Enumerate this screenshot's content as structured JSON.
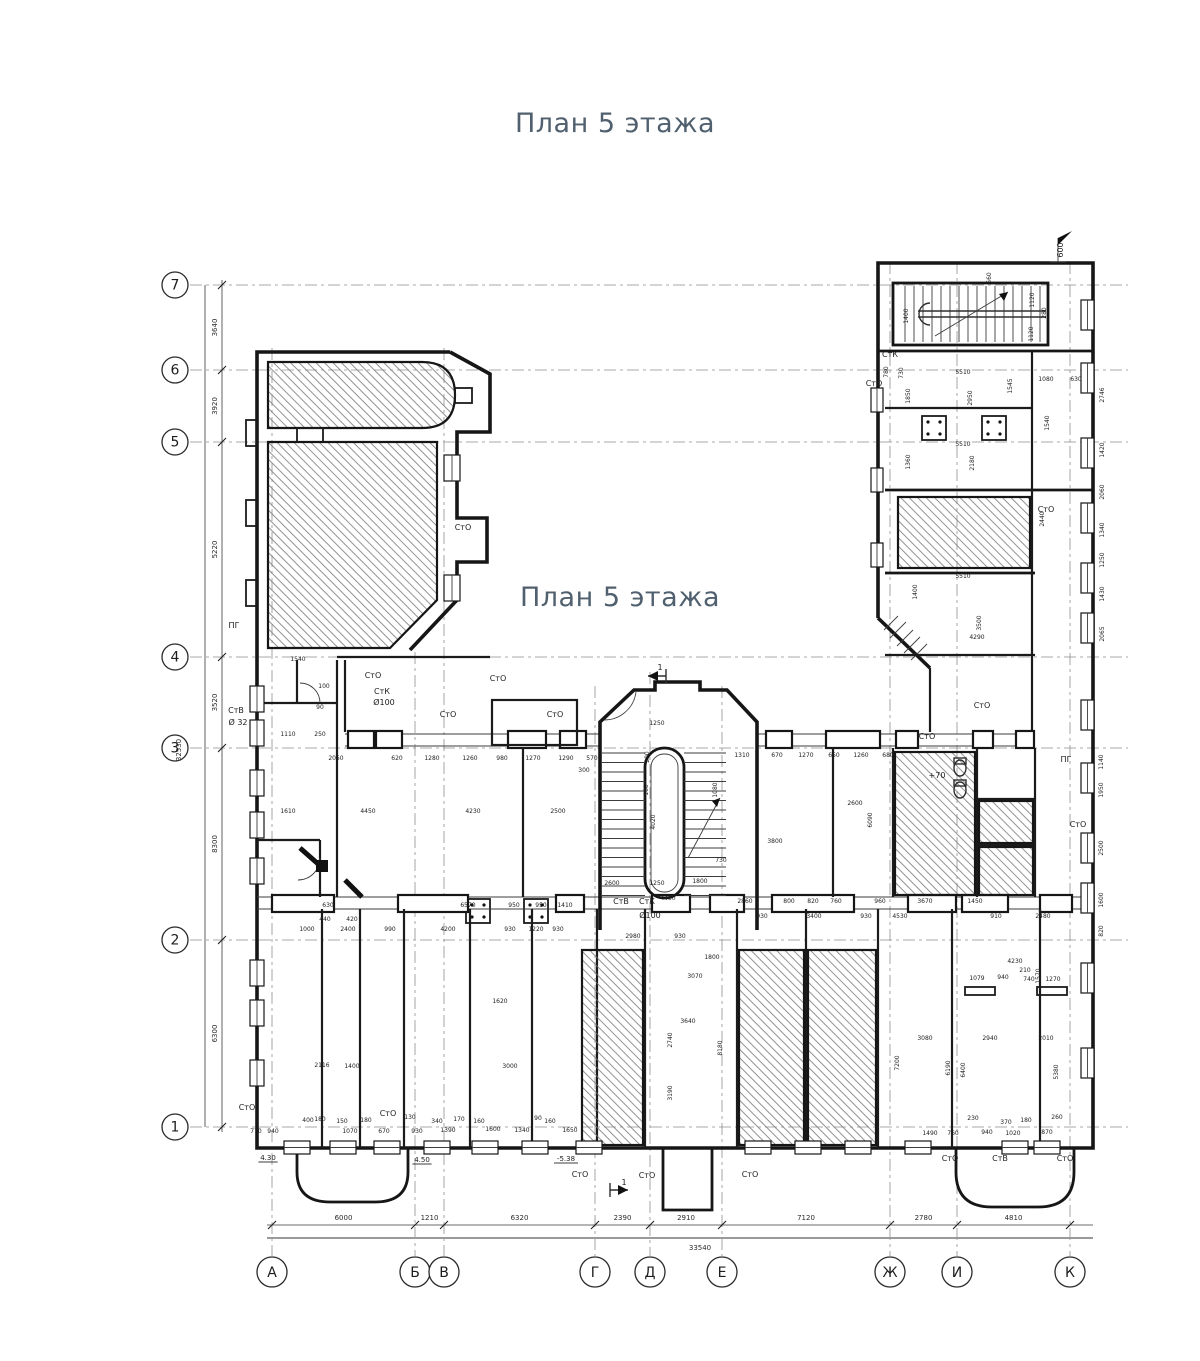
{
  "titles": {
    "top": "План 5 этажа",
    "middle": "План 5 этажа"
  },
  "colors": {
    "title": "#50606e",
    "wall": "#161616",
    "axis": "#8f8f8f",
    "dim": "#272727"
  },
  "grid": {
    "rows": [
      {
        "label": "7",
        "y": 285
      },
      {
        "label": "6",
        "y": 370
      },
      {
        "label": "5",
        "y": 442
      },
      {
        "label": "4",
        "y": 657
      },
      {
        "label": "3",
        "y": 748
      },
      {
        "label": "2",
        "y": 940
      },
      {
        "label": "1",
        "y": 1127
      }
    ],
    "cols": [
      {
        "label": "А",
        "x": 272,
        "y_top": 348
      },
      {
        "label": "Б",
        "x": 415,
        "y_top": 652
      },
      {
        "label": "В",
        "x": 444,
        "y_top": 348
      },
      {
        "label": "Г",
        "x": 595,
        "y_top": 686
      },
      {
        "label": "Д",
        "x": 650,
        "y_top": 672
      },
      {
        "label": "Е",
        "x": 722,
        "y_top": 686
      },
      {
        "label": "Ж",
        "x": 890,
        "y_top": 262
      },
      {
        "label": "И",
        "x": 957,
        "y_top": 262
      },
      {
        "label": "К",
        "x": 1070,
        "y_top": 262
      }
    ]
  },
  "chains": {
    "bottom": {
      "labels": [
        "6000",
        "1210",
        "6320",
        "2390",
        "2910",
        "7120",
        "2780",
        "4810"
      ],
      "total": "33540"
    },
    "left": {
      "labels": [
        "3640",
        "3920",
        "5220",
        "3520",
        "8300",
        "6300"
      ],
      "total": "32530"
    }
  },
  "annotations": {
    "labels": [
      [
        "СтО",
        373,
        678
      ],
      [
        "СтО",
        498,
        681
      ],
      [
        "СтК",
        382,
        694
      ],
      [
        "Ø100",
        384,
        705
      ],
      [
        "СтВ",
        236,
        713
      ],
      [
        "Ø 32",
        238,
        725
      ],
      [
        "ПГ",
        234,
        628
      ],
      [
        "СтО",
        448,
        717
      ],
      [
        "СтО",
        555,
        717
      ],
      [
        "СтО",
        463,
        530
      ],
      [
        "СтК",
        890,
        357
      ],
      [
        "СтО",
        874,
        386
      ],
      [
        "СтО",
        1046,
        512
      ],
      [
        "СтО",
        927,
        739
      ],
      [
        "СтО",
        982,
        708
      ],
      [
        "ПГ",
        1066,
        762
      ],
      [
        "СтО",
        1078,
        827
      ],
      [
        "СтВ",
        621,
        904
      ],
      [
        "СтК",
        647,
        904
      ],
      [
        "Ø100",
        650,
        918
      ],
      [
        "СтО",
        247,
        1110
      ],
      [
        "СтО",
        388,
        1116
      ],
      [
        "СтО",
        580,
        1177
      ],
      [
        "СтО",
        647,
        1178
      ],
      [
        "СтО",
        750,
        1177
      ],
      [
        "СтО",
        950,
        1161
      ],
      [
        "СтВ",
        1000,
        1161
      ],
      [
        "СтО",
        1065,
        1161
      ],
      [
        "+70",
        937,
        778
      ],
      [
        "4.30",
        268,
        1160
      ],
      [
        "4.50",
        422,
        1162
      ],
      [
        "-5.38",
        566,
        1161
      ],
      [
        "1",
        660,
        670,
        0,
        8
      ],
      [
        "1",
        624,
        1185,
        0,
        8
      ],
      [
        "600",
        1063,
        250,
        1
      ]
    ],
    "dims": [
      [
        "2050",
        336,
        760
      ],
      [
        "620",
        397,
        760
      ],
      [
        "1280",
        432,
        760
      ],
      [
        "1260",
        470,
        760
      ],
      [
        "980",
        502,
        760
      ],
      [
        "1270",
        533,
        760
      ],
      [
        "1290",
        566,
        760
      ],
      [
        "570",
        592,
        760
      ],
      [
        "300",
        584,
        772
      ],
      [
        "1310",
        742,
        757
      ],
      [
        "670",
        777,
        757
      ],
      [
        "1270",
        806,
        757
      ],
      [
        "650",
        834,
        757
      ],
      [
        "1260",
        861,
        757
      ],
      [
        "680",
        888,
        757
      ],
      [
        "1610",
        288,
        813
      ],
      [
        "4450",
        368,
        813
      ],
      [
        "4230",
        473,
        813
      ],
      [
        "2500",
        558,
        813
      ],
      [
        "2600",
        855,
        805
      ],
      [
        "3800",
        775,
        843
      ],
      [
        "6090",
        872,
        820,
        1
      ],
      [
        "630",
        328,
        907
      ],
      [
        "6570",
        468,
        907
      ],
      [
        "950",
        514,
        907
      ],
      [
        "950",
        541,
        907
      ],
      [
        "1410",
        565,
        907
      ],
      [
        "440",
        325,
        921
      ],
      [
        "420",
        352,
        921
      ],
      [
        "1000",
        307,
        931
      ],
      [
        "2400",
        348,
        931
      ],
      [
        "990",
        390,
        931
      ],
      [
        "4200",
        448,
        931
      ],
      [
        "930",
        510,
        931
      ],
      [
        "1220",
        536,
        931
      ],
      [
        "930",
        558,
        931
      ],
      [
        "2860",
        745,
        903
      ],
      [
        "800",
        789,
        903
      ],
      [
        "820",
        813,
        903
      ],
      [
        "760",
        836,
        903
      ],
      [
        "960",
        880,
        903
      ],
      [
        "3670",
        925,
        903
      ],
      [
        "1450",
        975,
        903
      ],
      [
        "930",
        762,
        918
      ],
      [
        "3400",
        814,
        918
      ],
      [
        "930",
        866,
        918
      ],
      [
        "4530",
        900,
        918
      ],
      [
        "910",
        996,
        918
      ],
      [
        "2480",
        1043,
        918
      ],
      [
        "1250",
        657,
        725
      ],
      [
        "200",
        649,
        757,
        1
      ],
      [
        "100",
        648,
        790,
        1
      ],
      [
        "4020",
        655,
        822,
        1
      ],
      [
        "1250",
        657,
        885
      ],
      [
        "2600",
        612,
        885
      ],
      [
        "1800",
        700,
        883
      ],
      [
        "4450",
        668,
        900
      ],
      [
        "2980",
        633,
        938
      ],
      [
        "930",
        680,
        938
      ],
      [
        "730",
        721,
        862
      ],
      [
        "1080",
        717,
        790,
        1
      ],
      [
        "660",
        991,
        278,
        1
      ],
      [
        "1120",
        1034,
        300,
        1
      ],
      [
        "280",
        1046,
        313,
        1
      ],
      [
        "1120",
        1033,
        334,
        1
      ],
      [
        "1400",
        908,
        316,
        1
      ],
      [
        "5510",
        963,
        374
      ],
      [
        "1545",
        1012,
        386,
        1
      ],
      [
        "1080",
        1046,
        381
      ],
      [
        "630",
        1076,
        381
      ],
      [
        "780",
        888,
        372,
        1
      ],
      [
        "730",
        903,
        373,
        1
      ],
      [
        "5510",
        963,
        446
      ],
      [
        "2950",
        972,
        398,
        1
      ],
      [
        "1850",
        910,
        396,
        1
      ],
      [
        "1360",
        910,
        462,
        1
      ],
      [
        "2180",
        974,
        463,
        1
      ],
      [
        "5510",
        963,
        578
      ],
      [
        "1400",
        917,
        592,
        1
      ],
      [
        "3500",
        981,
        623,
        1
      ],
      [
        "4290",
        977,
        639
      ],
      [
        "2440",
        1044,
        519,
        1
      ],
      [
        "1540",
        1049,
        423,
        1
      ],
      [
        "2746",
        1104,
        395,
        1
      ],
      [
        "1420",
        1104,
        450,
        1
      ],
      [
        "2060",
        1104,
        492,
        1
      ],
      [
        "1340",
        1104,
        530,
        1
      ],
      [
        "1250",
        1104,
        560,
        1
      ],
      [
        "1430",
        1104,
        594,
        1
      ],
      [
        "2065",
        1104,
        634,
        1
      ],
      [
        "1140",
        1103,
        762,
        1
      ],
      [
        "1950",
        1103,
        790,
        1
      ],
      [
        "2500",
        1103,
        848,
        1
      ],
      [
        "1600",
        1103,
        900,
        1
      ],
      [
        "820",
        1103,
        931,
        1
      ],
      [
        "2116",
        322,
        1067
      ],
      [
        "1400",
        352,
        1068
      ],
      [
        "3000",
        510,
        1068
      ],
      [
        "1620",
        500,
        1003
      ],
      [
        "1800",
        712,
        959
      ],
      [
        "3070",
        695,
        978
      ],
      [
        "3640",
        688,
        1023
      ],
      [
        "2740",
        672,
        1040,
        1
      ],
      [
        "3190",
        672,
        1093,
        1
      ],
      [
        "8180",
        722,
        1048,
        1
      ],
      [
        "3080",
        925,
        1040
      ],
      [
        "2940",
        990,
        1040
      ],
      [
        "2010",
        1046,
        1040
      ],
      [
        "4230",
        1015,
        963
      ],
      [
        "1079",
        977,
        980
      ],
      [
        "940",
        1003,
        979
      ],
      [
        "740",
        1029,
        981
      ],
      [
        "1270",
        1053,
        981
      ],
      [
        "210",
        1025,
        972
      ],
      [
        "7200",
        899,
        1063,
        1
      ],
      [
        "6190",
        950,
        1068,
        1
      ],
      [
        "6400",
        965,
        1070,
        1
      ],
      [
        "5380",
        1058,
        1072,
        1
      ],
      [
        "1570",
        1040,
        976,
        1
      ],
      [
        "770",
        256,
        1133
      ],
      [
        "940",
        273,
        1133
      ],
      [
        "1070",
        350,
        1133
      ],
      [
        "670",
        384,
        1133
      ],
      [
        "930",
        417,
        1133
      ],
      [
        "1390",
        448,
        1132
      ],
      [
        "1600",
        493,
        1131
      ],
      [
        "1340",
        522,
        1132
      ],
      [
        "1650",
        570,
        1132
      ],
      [
        "400",
        308,
        1122
      ],
      [
        "180",
        320,
        1121
      ],
      [
        "150",
        342,
        1123
      ],
      [
        "180",
        366,
        1122
      ],
      [
        "130",
        410,
        1119
      ],
      [
        "340",
        437,
        1123
      ],
      [
        "170",
        459,
        1121
      ],
      [
        "160",
        479,
        1123
      ],
      [
        "90",
        538,
        1120
      ],
      [
        "160",
        550,
        1123
      ],
      [
        "1490",
        930,
        1135
      ],
      [
        "760",
        953,
        1135
      ],
      [
        "940",
        987,
        1134
      ],
      [
        "1020",
        1013,
        1135
      ],
      [
        "870",
        1047,
        1134
      ],
      [
        "230",
        973,
        1120
      ],
      [
        "370",
        1006,
        1124
      ],
      [
        "180",
        1026,
        1122
      ],
      [
        "260",
        1057,
        1119
      ],
      [
        "1540",
        298,
        661
      ],
      [
        "100",
        324,
        688
      ],
      [
        "90",
        320,
        709
      ],
      [
        "250",
        320,
        736
      ],
      [
        "1110",
        288,
        736
      ]
    ]
  }
}
